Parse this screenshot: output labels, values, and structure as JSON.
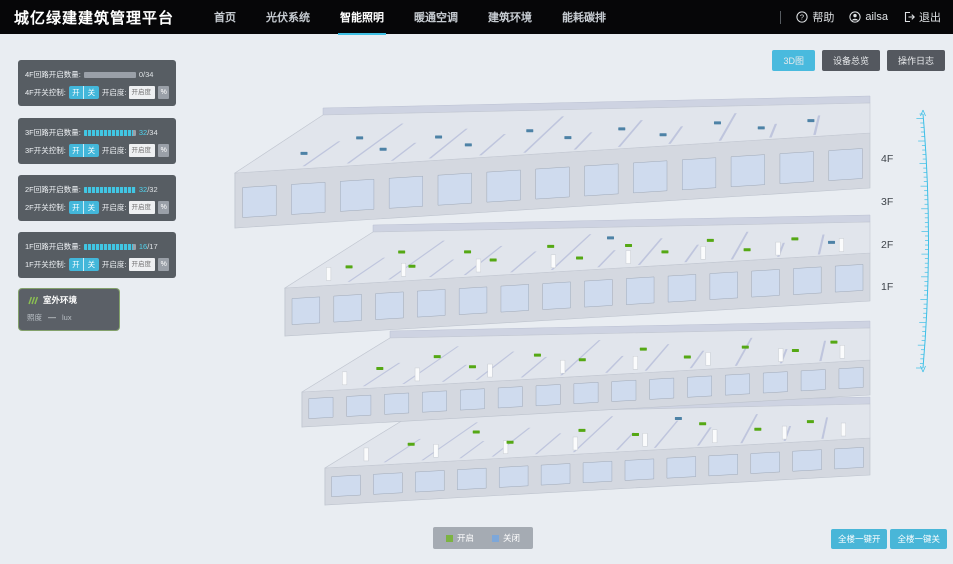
{
  "header": {
    "title": "城亿绿建建筑管理平台",
    "nav": [
      {
        "label": "首页",
        "active": false
      },
      {
        "label": "光伏系统",
        "active": false
      },
      {
        "label": "智能照明",
        "active": true
      },
      {
        "label": "暖通空调",
        "active": false
      },
      {
        "label": "建筑环境",
        "active": false
      },
      {
        "label": "能耗碳排",
        "active": false
      }
    ],
    "help": "帮助",
    "username": "ailsa",
    "logout": "退出"
  },
  "toolbar": {
    "buttons": [
      {
        "label": "3D图",
        "active": true
      },
      {
        "label": "设备总览",
        "active": false
      },
      {
        "label": "操作日志",
        "active": false
      }
    ]
  },
  "floor_panels": [
    {
      "count_label": "4F回路开启数量:",
      "open": "0",
      "total": "/34",
      "percent": 0,
      "switch_label": "4F开关控制:",
      "btn_on": "开",
      "btn_off": "关",
      "openness_label": "开启度:",
      "placeholder": "开启度",
      "unit": "%"
    },
    {
      "count_label": "3F回路开启数量:",
      "open": "32",
      "total": "/34",
      "percent": 94,
      "switch_label": "3F开关控制:",
      "btn_on": "开",
      "btn_off": "关",
      "openness_label": "开启度:",
      "placeholder": "开启度",
      "unit": "%"
    },
    {
      "count_label": "2F回路开启数量:",
      "open": "32",
      "total": "/32",
      "percent": 100,
      "switch_label": "2F开关控制:",
      "btn_on": "开",
      "btn_off": "关",
      "openness_label": "开启度:",
      "placeholder": "开启度",
      "unit": "%"
    },
    {
      "count_label": "1F回路开启数量:",
      "open": "16",
      "total": "/17",
      "percent": 94,
      "switch_label": "1F开关控制:",
      "btn_on": "开",
      "btn_off": "关",
      "openness_label": "开启度:",
      "placeholder": "开启度",
      "unit": "%"
    }
  ],
  "outdoor": {
    "title": "室外环境",
    "metric_label": "照度",
    "metric_value": "—",
    "metric_unit": "lux"
  },
  "floor_labels": [
    "4F",
    "3F",
    "2F",
    "1F"
  ],
  "legend": {
    "on_label": "开启",
    "on_color": "#7cb342",
    "off_label": "关闭",
    "off_color": "#7da7d9"
  },
  "bottom_buttons": {
    "all_on": "全楼一键开",
    "all_off": "全楼一键关"
  },
  "colors": {
    "accent": "#47b9db",
    "marker_on": "#55a814",
    "marker_off": "#4d82a6"
  }
}
